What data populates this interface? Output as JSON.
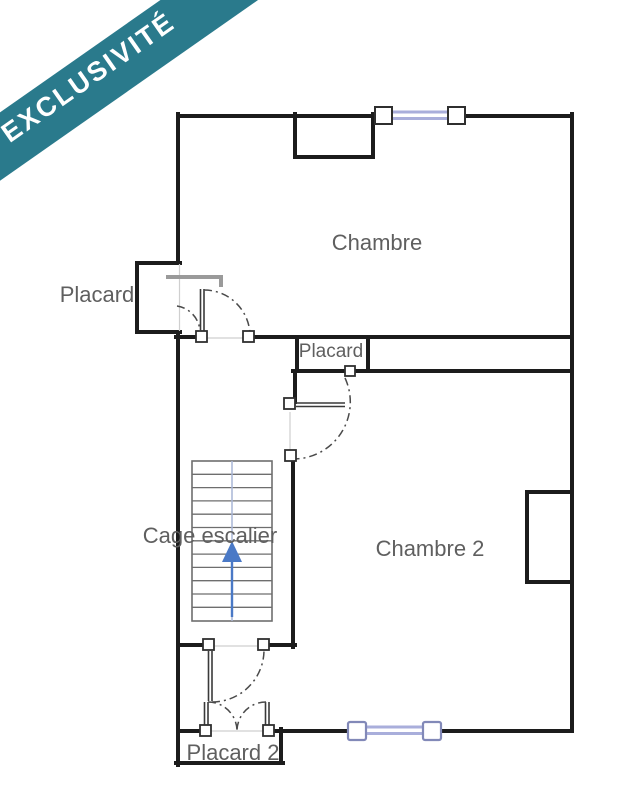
{
  "banner": {
    "label": "EXCLUSIVITÉ",
    "color": "#2a7a8c",
    "text_color": "#ffffff"
  },
  "floor_plan": {
    "rooms": [
      {
        "id": "chambre",
        "label": "Chambre"
      },
      {
        "id": "placard-left",
        "label": "Placard"
      },
      {
        "id": "placard-middle",
        "label": "Placard"
      },
      {
        "id": "cage-escalier",
        "label": "Cage escalier"
      },
      {
        "id": "chambre-2",
        "label": "Chambre 2"
      },
      {
        "id": "placard-2",
        "label": "Placard 2"
      }
    ],
    "colors": {
      "wall": "#1c1c1c",
      "label": "#5f5f5f",
      "window_glass": "#a9aedb",
      "window_frame_dark": "#2f2f2f",
      "window_frame_blue": "#8289b8",
      "stair_arrow": "#4a79c6",
      "stair_guide": "#a9b6d6",
      "door_arc": "#4a4a4a",
      "open_door": "#9a9a9a"
    }
  }
}
